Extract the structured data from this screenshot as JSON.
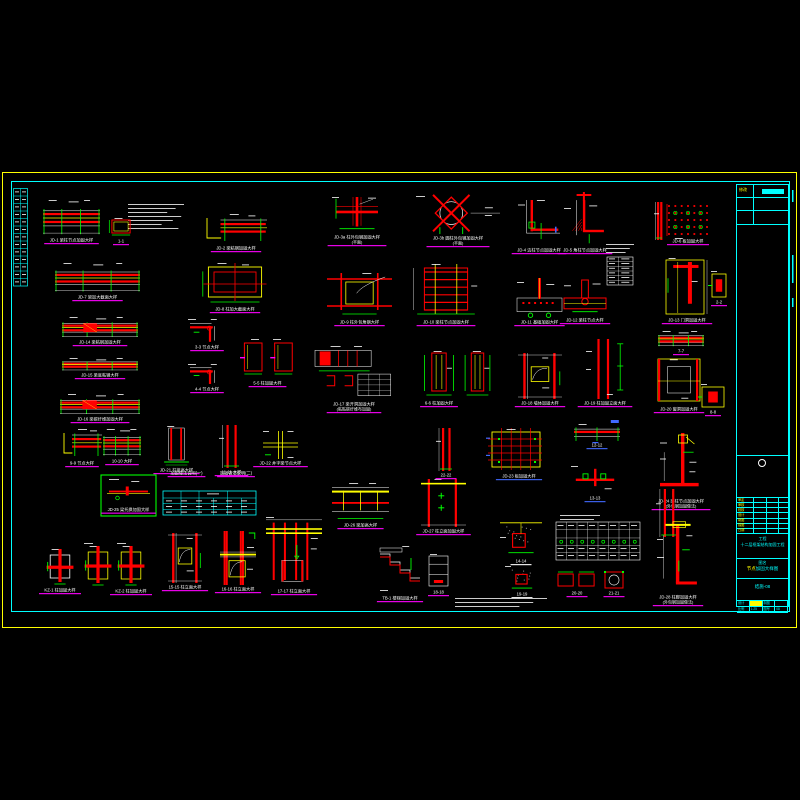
{
  "sheet": {
    "description": "structural reinforcement detail sheet, CAD on black",
    "colors": {
      "red": "#ff0000",
      "yellow": "#ffff00",
      "green": "#00ff00",
      "cyan": "#00ffff",
      "magenta": "#ff00ff",
      "white": "#ffffff",
      "blue": "#4169ff",
      "gray": "#9a9a9a"
    },
    "border_outer_color": "#ffff00",
    "border_inner_color": "#00ffff"
  },
  "left_table": {
    "rows": 13
  },
  "title_block": {
    "revision": {
      "label": "修改"
    },
    "fields": [
      "审定",
      "审核",
      "校核",
      "设计",
      "制图",
      "描图",
      "日期"
    ],
    "project": {
      "label": "工程",
      "value": "十二层框架结构加固工程"
    },
    "drawing": {
      "label": "图名",
      "value_hl": "节点",
      "value_rest": "加固大样图"
    },
    "number": "结施-08",
    "bottom": {
      "r1": [
        "设计",
        "",
        "制图",
        ""
      ],
      "r2": [
        "比例",
        "1:25",
        "图号",
        "08"
      ]
    }
  },
  "details": [
    {
      "id": "d01",
      "x": 43,
      "y": 200,
      "w": 57,
      "h": 36,
      "t": "beamH",
      "cap": "JD-1 梁柱节点加固大样"
    },
    {
      "id": "d02",
      "x": 128,
      "y": 204,
      "w": 56,
      "h": 28,
      "t": "notes"
    },
    {
      "id": "d03",
      "x": 108,
      "y": 218,
      "w": 26,
      "h": 19,
      "t": "colSect",
      "cap": "1-1"
    },
    {
      "id": "d04",
      "x": 205,
      "y": 214,
      "w": 62,
      "h": 30,
      "t": "beamStep",
      "cap": "JD-2 梁粘钢加固大样"
    },
    {
      "id": "d05",
      "x": 332,
      "y": 197,
      "w": 50,
      "h": 36,
      "t": "cross",
      "cap": "JD-3a 柱外包钢加固大样",
      "cap2": "(平面)"
    },
    {
      "id": "d06",
      "x": 416,
      "y": 196,
      "w": 84,
      "h": 38,
      "t": "circleX",
      "cap": "JD-3b 圆柱外包钢加固大样",
      "cap2": "(平面)"
    },
    {
      "id": "d07",
      "x": 518,
      "y": 200,
      "w": 42,
      "h": 46,
      "t": "Ljoint",
      "cap": "JD-4 边柱节点加固大样"
    },
    {
      "id": "d08",
      "x": 564,
      "y": 192,
      "w": 42,
      "h": 54,
      "t": "LjointH",
      "cap": "JD-5 角柱节点加固大样"
    },
    {
      "id": "d09",
      "x": 606,
      "y": 244,
      "w": 28,
      "h": 10,
      "t": "notes"
    },
    {
      "id": "d10",
      "x": 607,
      "y": 257,
      "w": 26,
      "h": 28,
      "t": "tableW"
    },
    {
      "id": "d11",
      "x": 654,
      "y": 202,
      "w": 10,
      "h": 38,
      "t": "colV"
    },
    {
      "id": "d12",
      "x": 666,
      "y": 203,
      "w": 44,
      "h": 34,
      "t": "dotGrid",
      "cap": "JD-6 板加固大样"
    },
    {
      "id": "d13",
      "x": 55,
      "y": 263,
      "w": 85,
      "h": 30,
      "t": "beamH",
      "cap": "JD-7 梁加大截面大样"
    },
    {
      "id": "d14",
      "x": 200,
      "y": 263,
      "w": 70,
      "h": 42,
      "t": "colPlanBig",
      "cap": "JD-8 柱加大截面大样"
    },
    {
      "id": "d15",
      "x": 331,
      "y": 273,
      "w": 57,
      "h": 45,
      "t": "boxFrame",
      "cap": "JD-9 柱外包角钢大样"
    },
    {
      "id": "d16",
      "x": 410,
      "y": 264,
      "w": 72,
      "h": 54,
      "t": "beamHatchV",
      "cap": "JD-10 梁柱节点加固大样"
    },
    {
      "id": "d17",
      "x": 517,
      "y": 278,
      "w": 45,
      "h": 40,
      "t": "footing2",
      "cap": "JD-11 基础加固大样"
    },
    {
      "id": "d18",
      "x": 564,
      "y": 280,
      "w": 42,
      "h": 36,
      "t": "TjointC",
      "cap": "JD-12 梁柱节点大样"
    },
    {
      "id": "d19",
      "x": 664,
      "y": 258,
      "w": 46,
      "h": 58,
      "t": "doorFrame",
      "cap": "JD-13 门洞加固大样"
    },
    {
      "id": "d20",
      "x": 711,
      "y": 273,
      "w": 16,
      "h": 25,
      "t": "smallBox",
      "cap": "2-2"
    },
    {
      "id": "d21",
      "x": 62,
      "y": 317,
      "w": 76,
      "h": 21,
      "t": "beamHatch",
      "cap": "JD-14 梁粘钢加固大样"
    },
    {
      "id": "d22",
      "x": 62,
      "y": 358,
      "w": 76,
      "h": 13,
      "t": "beamH",
      "cap": "JD-15 梁底粘钢大样"
    },
    {
      "id": "d23",
      "x": 60,
      "y": 394,
      "w": 80,
      "h": 21,
      "t": "beamHatch",
      "cap": "JD-16 梁碳纤维加固大样"
    },
    {
      "id": "d24",
      "x": 188,
      "y": 319,
      "w": 38,
      "h": 24,
      "t": "LjointS",
      "cap": "3-3 节点大样"
    },
    {
      "id": "d25",
      "x": 188,
      "y": 364,
      "w": 38,
      "h": 21,
      "t": "LjointS",
      "cap": "4-4 节点大样"
    },
    {
      "id": "d26",
      "x": 240,
      "y": 339,
      "w": 55,
      "h": 40,
      "t": "colSectPair",
      "cap": "5-5 柱加固大样"
    },
    {
      "id": "d27",
      "x": 315,
      "y": 346,
      "w": 78,
      "h": 54,
      "t": "beamPlan",
      "cap": "JD-17 梁开洞加固大样",
      "cap2": "(粘贴碳纤维布加固)"
    },
    {
      "id": "d28",
      "x": 421,
      "y": 351,
      "w": 36,
      "h": 48,
      "t": "colSectV",
      "cap": "6-6 柱加固大样"
    },
    {
      "id": "d29",
      "x": 462,
      "y": 351,
      "w": 31,
      "h": 48,
      "t": "colSectV"
    },
    {
      "id": "d30",
      "x": 518,
      "y": 353,
      "w": 44,
      "h": 46,
      "t": "colElev",
      "cap": "JD-18 墙体加固大样"
    },
    {
      "id": "d31",
      "x": 586,
      "y": 339,
      "w": 38,
      "h": 60,
      "t": "colVdim",
      "cap": "JD-19 柱加固立面大样"
    },
    {
      "id": "d32",
      "x": 658,
      "y": 331,
      "w": 46,
      "h": 16,
      "t": "beamH",
      "cap": "7-7"
    },
    {
      "id": "d33",
      "x": 656,
      "y": 357,
      "w": 46,
      "h": 48,
      "t": "windowBox",
      "cap": "JD-20 窗洞加固大样"
    },
    {
      "id": "d34",
      "x": 701,
      "y": 386,
      "w": 24,
      "h": 22,
      "t": "smallBox",
      "cap": "8-8"
    },
    {
      "id": "d35",
      "x": 62,
      "y": 429,
      "w": 40,
      "h": 30,
      "t": "beamStep",
      "cap": "9-9 节点大样"
    },
    {
      "id": "d36",
      "x": 103,
      "y": 429,
      "w": 38,
      "h": 28,
      "t": "beamH",
      "cap": "10-10 大样"
    },
    {
      "id": "d37",
      "x": 161,
      "y": 426,
      "w": 31,
      "h": 40,
      "t": "colElevN",
      "cap": "JD-21 柱接高大样"
    },
    {
      "id": "d38",
      "x": 219,
      "y": 425,
      "w": 25,
      "h": 43,
      "t": "colV",
      "cap": "11-11 大样"
    },
    {
      "id": "d39",
      "x": 263,
      "y": 431,
      "w": 35,
      "h": 28,
      "t": "crossY",
      "cap": "JD-22 井字梁节点大样"
    },
    {
      "id": "d40",
      "x": 488,
      "y": 429,
      "w": 62,
      "h": 43,
      "t": "slabGrid",
      "cap": "JD-23 板加固大样",
      "cc": "#4169ff"
    },
    {
      "id": "d41",
      "x": 574,
      "y": 424,
      "w": 46,
      "h": 17,
      "t": "beamHb",
      "cap": "12-12",
      "cc": "#4169ff"
    },
    {
      "id": "d42",
      "x": 571,
      "y": 466,
      "w": 48,
      "h": 28,
      "t": "TjointR",
      "cap": "13-13",
      "cc": "#4169ff"
    },
    {
      "id": "d43",
      "x": 660,
      "y": 433,
      "w": 42,
      "h": 64,
      "t": "bigL",
      "cap": "JD-24 梁柱节点加固大样",
      "cap2": "(外包钢加固做法)"
    },
    {
      "id": "d44",
      "x": 101,
      "y": 475,
      "w": 55,
      "h": 41,
      "t": "greenBox",
      "cap": "JD-25 梁托换加固大样"
    },
    {
      "id": "d45",
      "x": 163,
      "y": 471,
      "w": 47,
      "h": 6,
      "t": "capLine",
      "cap": "加固做法说明(一)"
    },
    {
      "id": "d46",
      "x": 215,
      "y": 471,
      "w": 42,
      "h": 6,
      "t": "capLine",
      "cap": "加固做法说明(二)"
    },
    {
      "id": "d47",
      "x": 163,
      "y": 491,
      "w": 93,
      "h": 24,
      "t": "tableC"
    },
    {
      "id": "d48",
      "x": 332,
      "y": 483,
      "w": 57,
      "h": 38,
      "t": "beamYband",
      "cap": "JD-26 梁加高大样"
    },
    {
      "id": "d49",
      "x": 421,
      "y": 479,
      "w": 45,
      "h": 48,
      "t": "colElevX",
      "cap": "JD-27 柱立面加固大样"
    },
    {
      "id": "d50",
      "x": 500,
      "y": 521,
      "w": 42,
      "h": 36,
      "t": "footingH",
      "cap": "14-14",
      "cc": "#ffffff"
    },
    {
      "id": "d51",
      "x": 560,
      "y": 515,
      "w": 40,
      "h": 6,
      "t": "notes"
    },
    {
      "id": "d52",
      "x": 556,
      "y": 522,
      "w": 84,
      "h": 38,
      "t": "tableW2"
    },
    {
      "id": "d53",
      "x": 656,
      "y": 489,
      "w": 26,
      "h": 48,
      "t": "colV"
    },
    {
      "id": "d54",
      "x": 46,
      "y": 549,
      "w": 28,
      "h": 37,
      "t": "colPlanW",
      "cap": "KZ-1 柱加固大样"
    },
    {
      "id": "d55",
      "x": 84,
      "y": 546,
      "w": 28,
      "h": 41,
      "t": "colPlanY"
    },
    {
      "id": "d56",
      "x": 117,
      "y": 546,
      "w": 28,
      "h": 41,
      "t": "colPlanY",
      "cap": "KZ-2 柱加固大样"
    },
    {
      "id": "d57",
      "x": 168,
      "y": 533,
      "w": 34,
      "h": 50,
      "t": "colElev",
      "cap": "15-15 柱立面大样"
    },
    {
      "id": "d58",
      "x": 220,
      "y": 531,
      "w": 36,
      "h": 54,
      "t": "colElev2",
      "cap": "16-16 柱立面大样"
    },
    {
      "id": "d59",
      "x": 266,
      "y": 517,
      "w": 56,
      "h": 70,
      "t": "colElevBig",
      "cap": "17-17 柱立面大样"
    },
    {
      "id": "d60",
      "x": 378,
      "y": 546,
      "w": 44,
      "h": 48,
      "t": "stair",
      "cap": "TB-1 楼梯加固大样"
    },
    {
      "id": "d61",
      "x": 427,
      "y": 554,
      "w": 23,
      "h": 34,
      "t": "boxW",
      "cap": "18-18"
    },
    {
      "id": "d62",
      "x": 505,
      "y": 566,
      "w": 34,
      "h": 24,
      "t": "footingH2",
      "cap": "19-19",
      "cc": "#ffffff"
    },
    {
      "id": "d63",
      "x": 558,
      "y": 571,
      "w": 38,
      "h": 18,
      "t": "twoBoxes",
      "cap": "20-20"
    },
    {
      "id": "d64",
      "x": 604,
      "y": 571,
      "w": 20,
      "h": 18,
      "t": "boxX",
      "cap": "21-21"
    },
    {
      "id": "d65",
      "x": 657,
      "y": 521,
      "w": 42,
      "h": 72,
      "t": "bigL2",
      "cap": "JD-28 柱脚加固大样",
      "cap2": "(外包钢加固做法)"
    },
    {
      "id": "d66",
      "x": 455,
      "y": 598,
      "w": 92,
      "h": 10,
      "t": "notes"
    },
    {
      "id": "d67",
      "x": 436,
      "y": 428,
      "w": 20,
      "h": 43,
      "t": "colV",
      "cap": "22-22"
    }
  ]
}
